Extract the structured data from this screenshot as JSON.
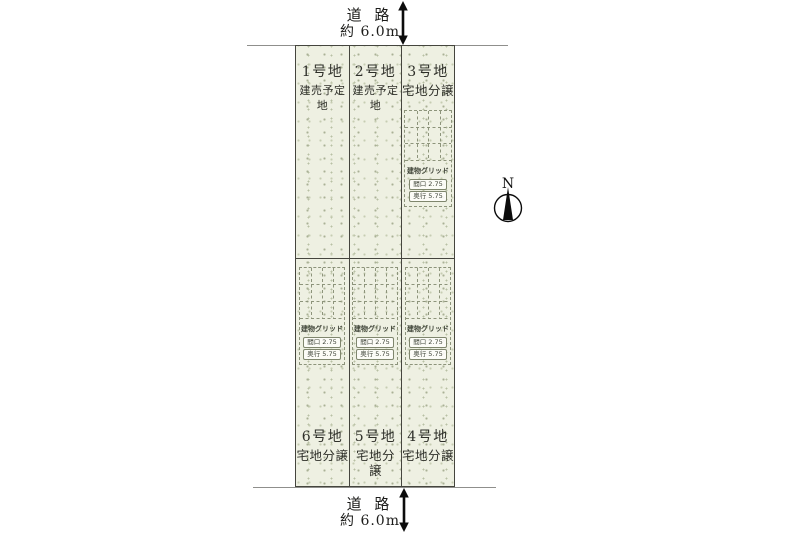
{
  "roads": {
    "top": {
      "label": "道 路",
      "width_label": "約 6.0m"
    },
    "bottom": {
      "label": "道 路",
      "width_label": "約 6.0m"
    }
  },
  "lots": [
    {
      "name": "1号地",
      "type": "建売予定地"
    },
    {
      "name": "2号地",
      "type": "建売予定地"
    },
    {
      "name": "3号地",
      "type": "宅地分譲"
    },
    {
      "name": "4号地",
      "type": "宅地分譲"
    },
    {
      "name": "5号地",
      "type": "宅地分譲"
    },
    {
      "name": "6号地",
      "type": "宅地分譲"
    }
  ],
  "building_grid": {
    "label": "建物グリッド",
    "frontage": "間口 2.75",
    "depth": "奥行 5.75"
  },
  "compass": {
    "label": "N"
  },
  "colors": {
    "lot_fill": "#eef0e2",
    "lot_border": "#45453e",
    "road_line": "#8f8f8c",
    "grid_dash": "#8d947b",
    "text": "#1c1c1a"
  }
}
